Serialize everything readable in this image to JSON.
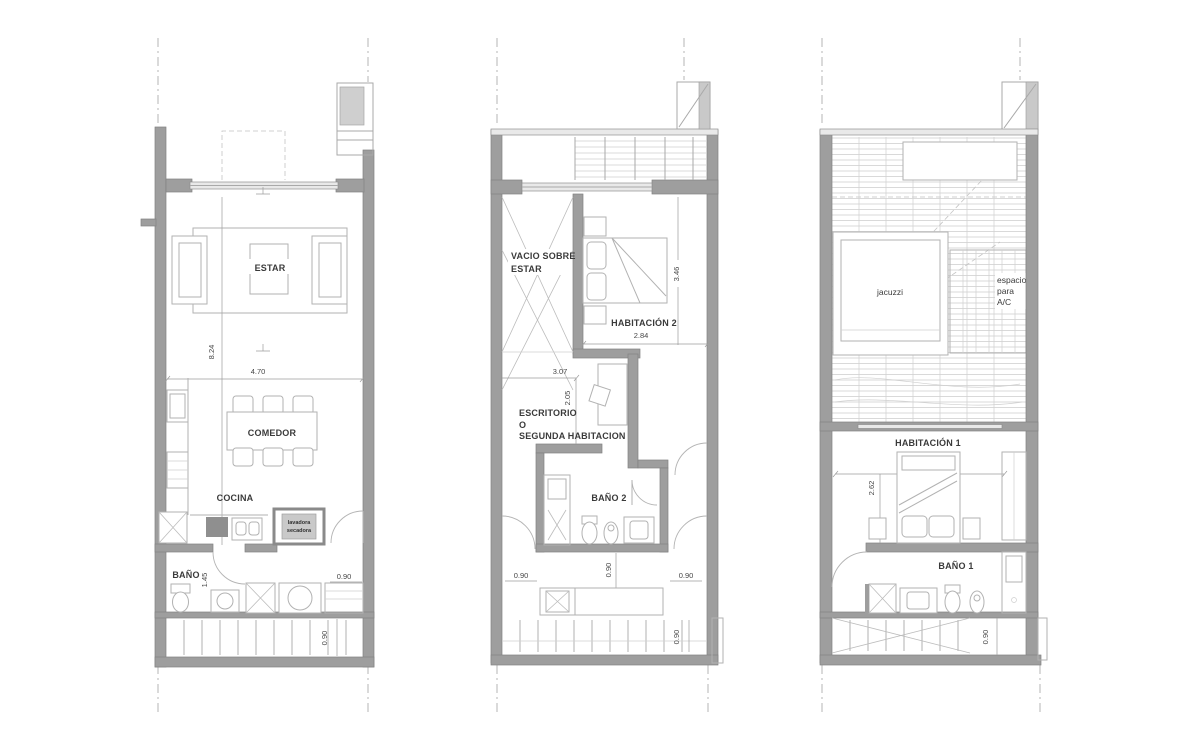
{
  "colors": {
    "background": "#ffffff",
    "wall": "#9e9e9e",
    "line": "#b2b2b2",
    "text": "#3a3a3a"
  },
  "plans": {
    "ground": {
      "labels": {
        "estar": "ESTAR",
        "comedor": "COMEDOR",
        "cocina": "COCINA",
        "bano": "BAÑO",
        "laundry1": "lavadora",
        "laundry2": "secadora"
      },
      "dims": {
        "length": "8.24",
        "width": "4.70",
        "bath_width": "1.45",
        "entry": "0.90",
        "stair": "0.90"
      }
    },
    "second": {
      "labels": {
        "void1": "VACIO SOBRE",
        "void2": "ESTAR",
        "hab2": "HABITACIÓN 2",
        "esc1": "ESCRITORIO",
        "esc2": "O",
        "esc3": "SEGUNDA HABITACION",
        "bano2": "BAÑO 2"
      },
      "dims": {
        "hab2_depth": "3.46",
        "hab2_width": "2.84",
        "esc_width": "3.07",
        "esc_depth": "2.05",
        "door_left": "0.90",
        "door_mid": "0.90",
        "door_right": "0.90",
        "stair": "0.90"
      }
    },
    "roof": {
      "labels": {
        "jacuzzi": "jacuzzi",
        "ac1": "espacio",
        "ac2": "para",
        "ac3": "A/C",
        "hab1": "HABITACIÓN 1",
        "bano1": "BAÑO 1"
      },
      "dims": {
        "hab1_width": "4.06",
        "hab1_depth": "2.62",
        "stair": "0.90"
      }
    }
  }
}
